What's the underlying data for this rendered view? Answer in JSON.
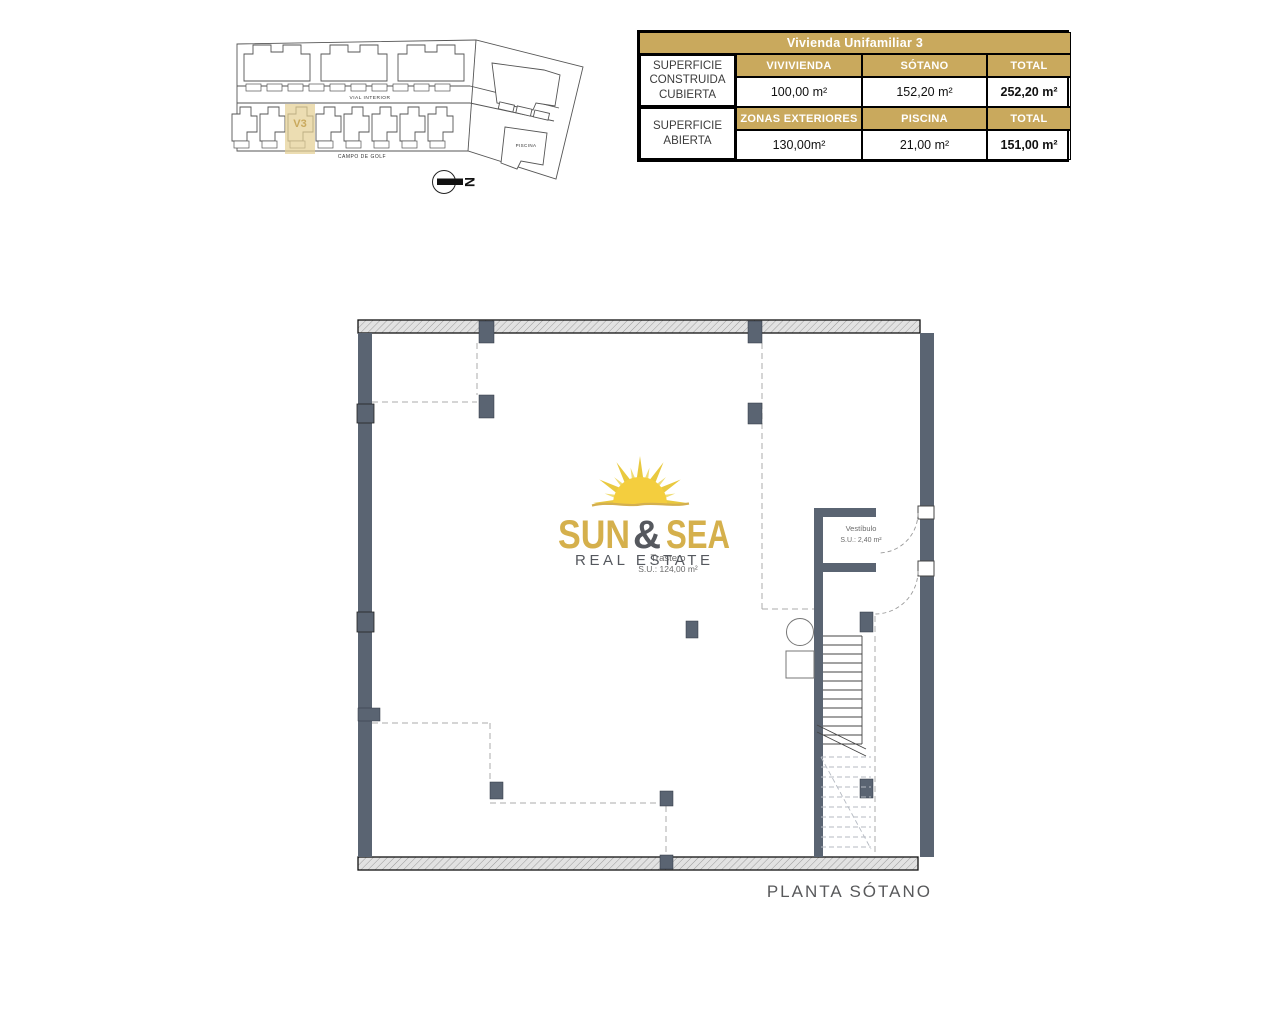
{
  "colors": {
    "brand_gold": "#C9A95D",
    "wall_gray": "#5A6472",
    "logo_yellow": "#F2CE3E",
    "logo_gold": "#D5B04C",
    "text_gray": "#58595B"
  },
  "site_plan": {
    "street_label": "VIAL INTERIOR",
    "bottom_label": "CAMPO DE GOLF",
    "pool_label": "PISCINA",
    "highlighted_unit": "V3",
    "north_letter": "N"
  },
  "area_table": {
    "title": "Vivienda Unifamiliar 3",
    "groups": [
      {
        "label": "SUPERFICIE CONSTRUIDA CUBIERTA",
        "headers": [
          "VIVIVIENDA",
          "SÓTANO",
          "TOTAL"
        ],
        "values": [
          "100,00 m²",
          "152,20 m²",
          "252,20 m²"
        ]
      },
      {
        "label": "SUPERFICIE ABIERTA",
        "headers": [
          "ZONAS EXTERIORES",
          "PISCINA",
          "TOTAL"
        ],
        "values": [
          "130,00m²",
          "21,00 m²",
          "151,00 m²"
        ]
      }
    ]
  },
  "logo": {
    "word1": "SUN",
    "ampersand": "&",
    "word2": "SEA",
    "tagline": "REAL ESTATE"
  },
  "floor_plan": {
    "rooms": [
      {
        "name": "Trastero",
        "area": "S.U.: 124,00 m²"
      },
      {
        "name": "Vestíbulo",
        "area": "S.U.: 2,40 m²"
      }
    ],
    "caption": "PLANTA SÓTANO"
  }
}
